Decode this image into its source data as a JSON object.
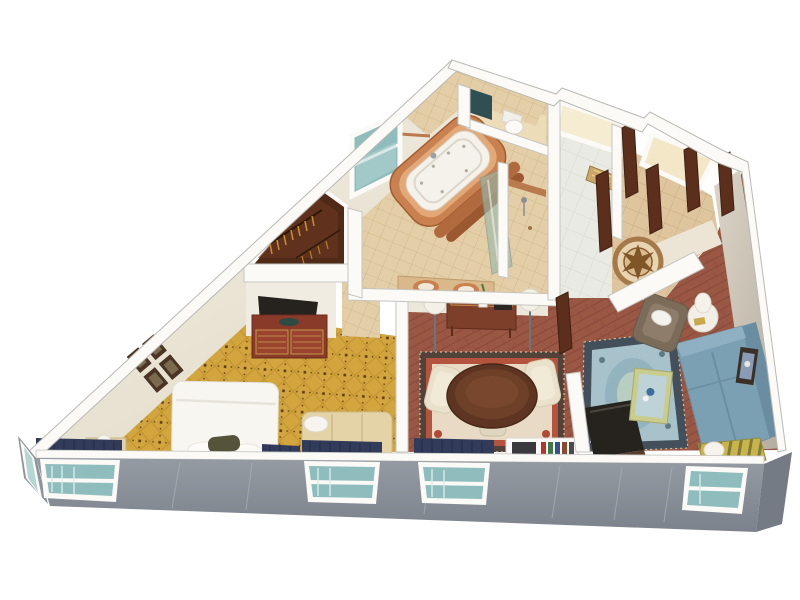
{
  "scene": {
    "type": "isometric-3d-floor-plan",
    "description": "3D cutaway rendering of a triangular hotel suite floor plan",
    "rooms": [
      {
        "id": "bedroom",
        "label": "Bedroom",
        "furniture": [
          "king-bed",
          "headboard",
          "red-dresser",
          "television",
          "bench-seat",
          "nightstand",
          "table-lamp",
          "wall-art-grid",
          "window-valances"
        ]
      },
      {
        "id": "walk-in-closet",
        "label": "Walk-in Closet",
        "furniture": [
          "clothes-rail",
          "hangers"
        ]
      },
      {
        "id": "bathroom",
        "label": "Bathroom",
        "furniture": [
          "jacuzzi-tub",
          "glass-shower",
          "shower-stall",
          "double-vanity",
          "corner-window"
        ]
      },
      {
        "id": "water-closet",
        "label": "Water Closet",
        "furniture": [
          "toilet",
          "mirror"
        ]
      },
      {
        "id": "entry-foyer",
        "label": "Entry Foyer",
        "furniture": [
          "floor-medallion",
          "entry-doors",
          "luggage-rack",
          "closets"
        ]
      },
      {
        "id": "dining-area",
        "label": "Dining Area",
        "furniture": [
          "oval-dining-table",
          "dining-chairs",
          "oriental-rug",
          "console-table",
          "flower-vase",
          "floor-lamps",
          "bookcase"
        ]
      },
      {
        "id": "living-room",
        "label": "Living Room",
        "furniture": [
          "blue-sofa",
          "armchair",
          "coffee-table",
          "blue-oriental-rug",
          "tv-cabinet",
          "round-side-table",
          "table-lamp",
          "wall-art",
          "striped-window-bench",
          "floor-lamp"
        ]
      }
    ],
    "window_count": 6,
    "door_count": 6
  },
  "palette": {
    "background": "#ffffff",
    "wallTop": "#fbfaf7",
    "wallEdge": "#bfbfba",
    "wallFaceWarm": "#efe8da",
    "wallFaceWarm2": "#e3dcc9",
    "exteriorGray": "#8d939b",
    "exteriorGrayDark": "#757b84",
    "glassTeal": "#8fbdbd",
    "glassTealLight": "#b5d6d4",
    "carpetGold": "#d2a53e",
    "carpetLine": "#c09231",
    "carpetDot": "#5c3a12",
    "tileBeige": "#e3cea7",
    "tileLine": "#cdb284",
    "terracotta": "#c9824f",
    "terracottaDark": "#a35c30",
    "tubWhite": "#f4f2ea",
    "marble": "#eaeae5",
    "woodFloor": "#9a5743",
    "woodFloorLine": "#88493a",
    "entryTile": "#dfc59e",
    "medallionRing": "#a5794a",
    "medallionStar": "#7e5628",
    "doorBrown": "#5c2f1c",
    "closetWood": "#4f2a17",
    "dresserRed": "#8a3a28",
    "dresserTrim": "#c79a4e",
    "tvDark": "#26231f",
    "bedWhite": "#f7f6f1",
    "pillowOlive": "#55543a",
    "benchTan": "#e3d3a6",
    "headboardTan": "#c9b68a",
    "valanceNavy": "#323c5a",
    "rugBorderDark": "#53423a",
    "rugBandRed": "#b5543e",
    "rugField": "#e8dac4",
    "rugMedallion": "#b04a38",
    "blueRugBorder": "#43505c",
    "blueRugField": "#a7c2cb",
    "blueRugMotif": "#8fb2bc",
    "sofaBlue": "#7ba0b4",
    "sofaBlueDark": "#6a8da1",
    "armchairBrown": "#7b6b59",
    "creamChair": "#e9e1cb",
    "sideTableWhite": "#f2efe8",
    "lampShade": "#f3f0e8",
    "coffeeTableTrim": "#c9cc8d",
    "coffeeGlass": "#bed3d8",
    "stripeGold": "#c8b44a",
    "stripeOlive": "#7f7a38",
    "consoleWood": "#7e3f2a",
    "glowCream": "#f6ecd2",
    "greigeWall": "#cfc8ba",
    "bookRed": "#b43430",
    "bookGreen": "#3f7a46",
    "bookNavy": "#35508c"
  }
}
